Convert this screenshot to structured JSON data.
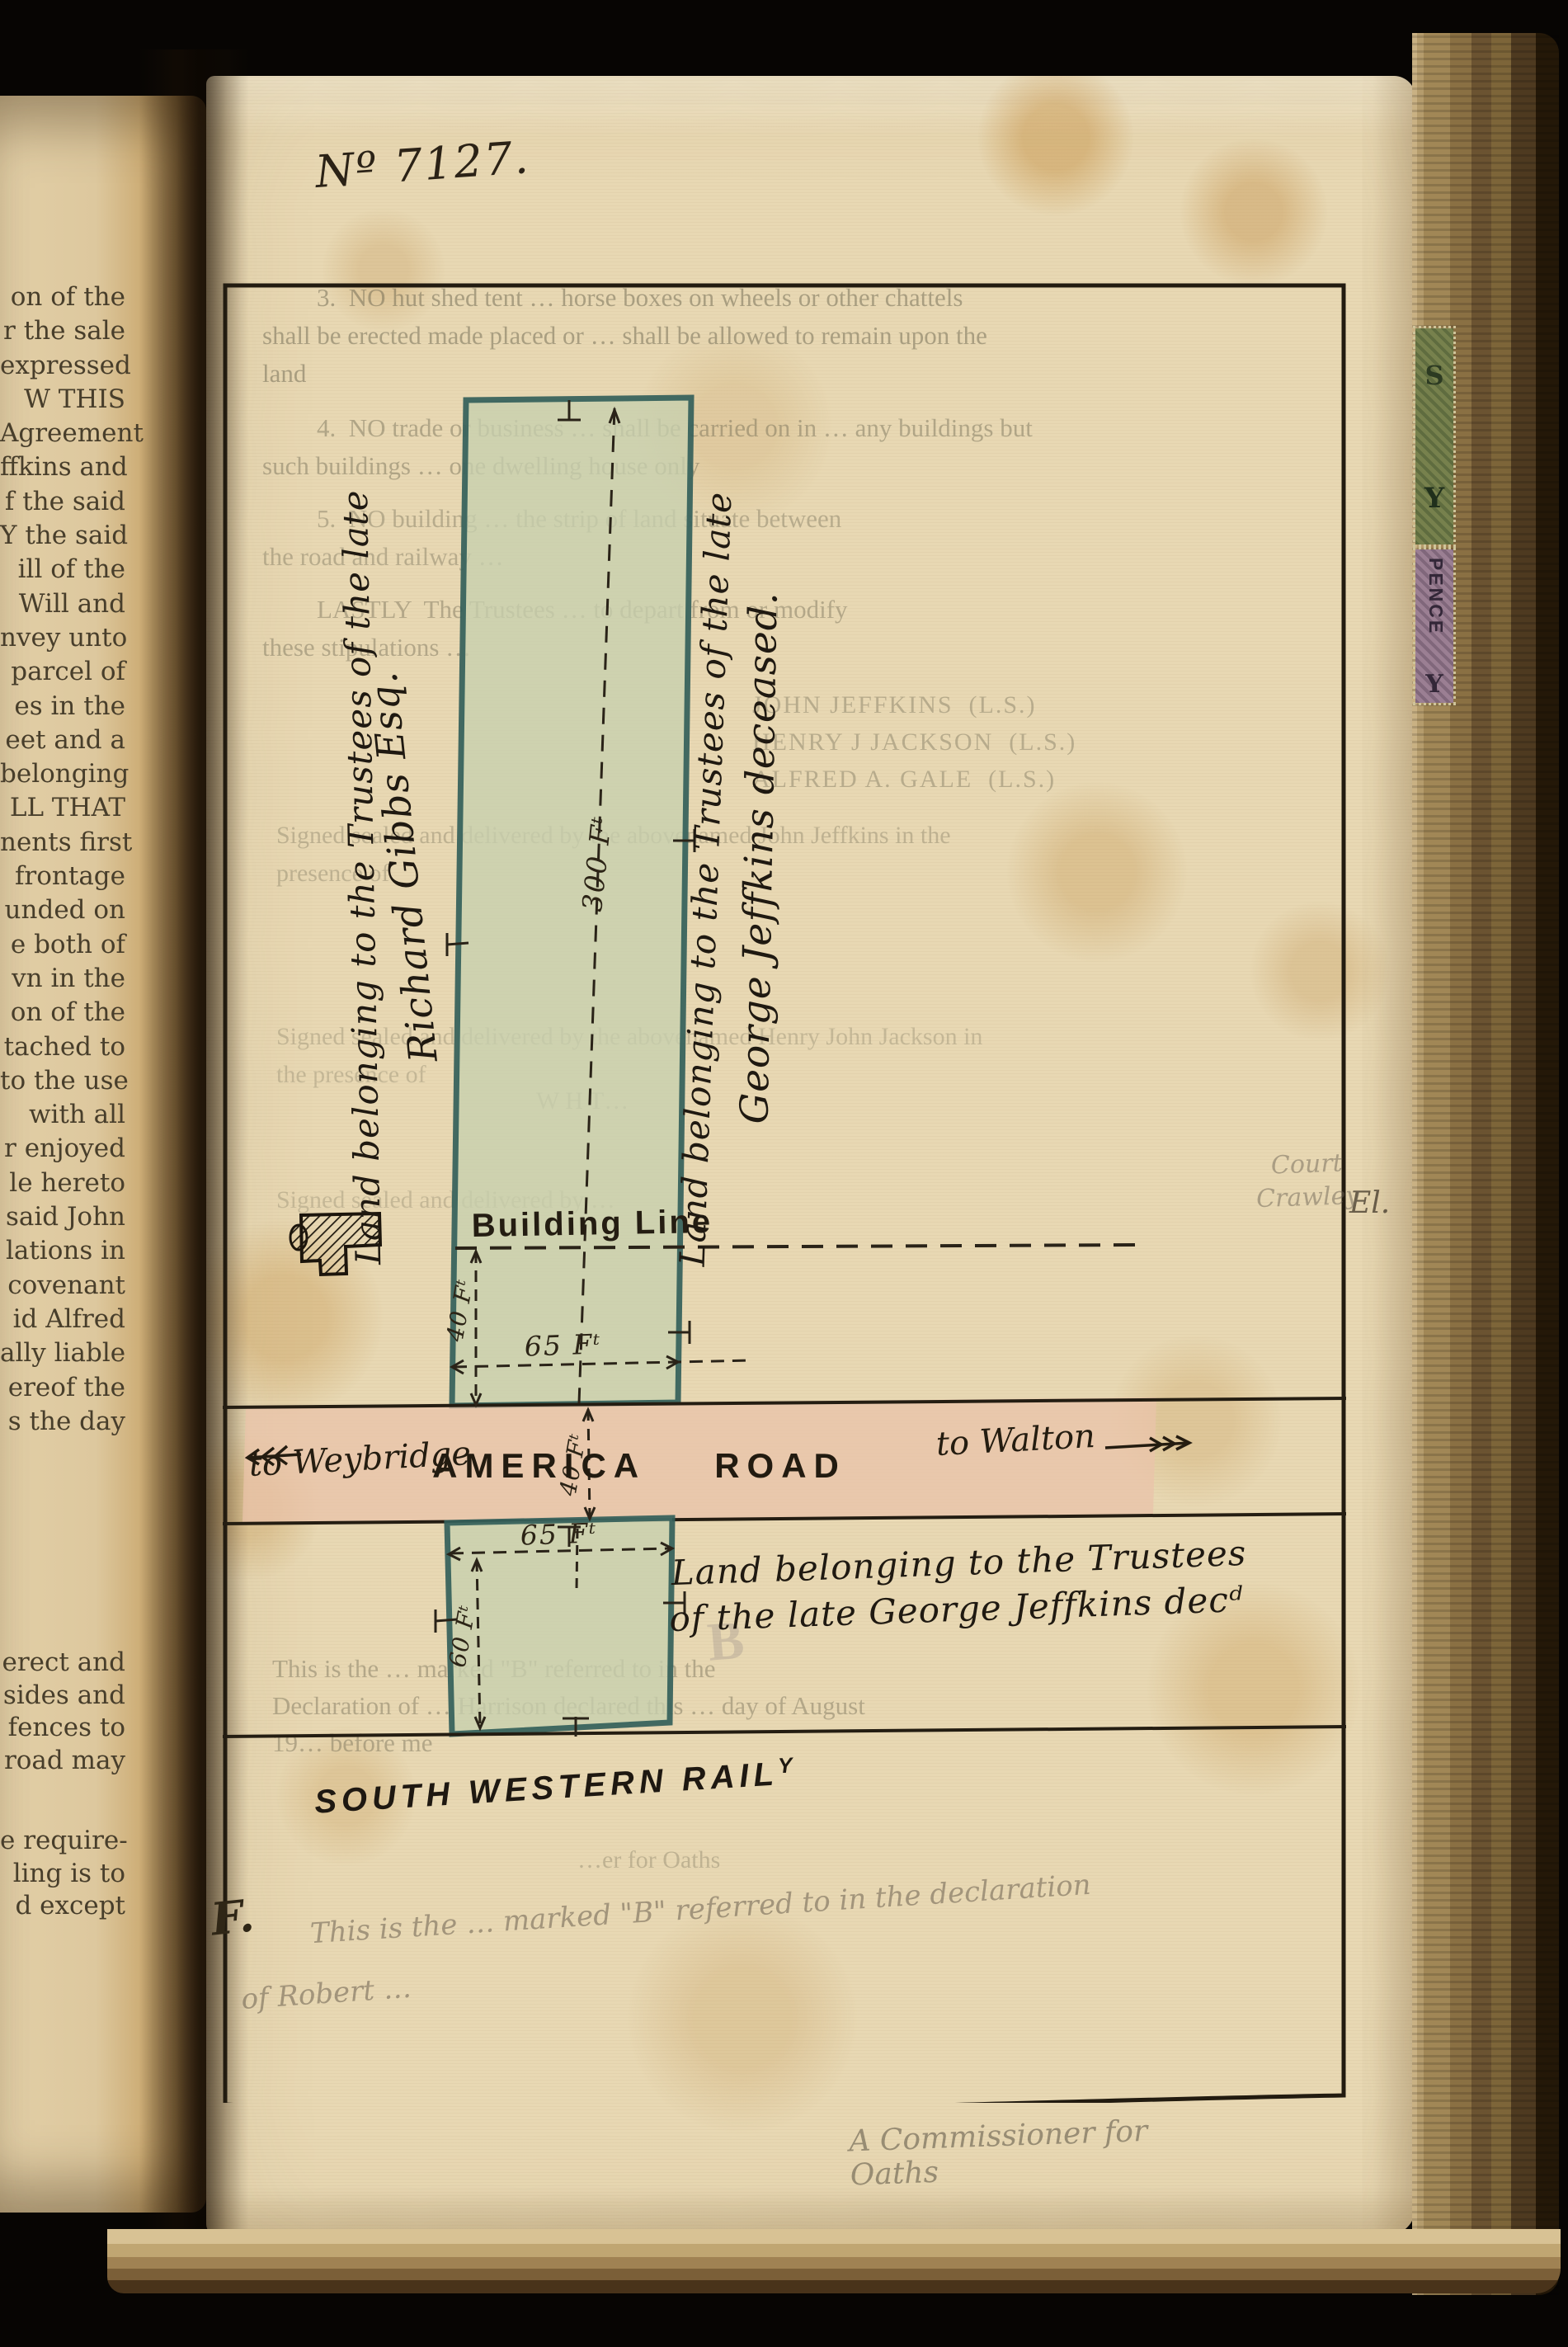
{
  "page_label": "Nº 7127.",
  "left_page": {
    "block1": [
      "on of the",
      "r the sale",
      "expressed",
      "W THIS",
      "Agreement",
      "ffkins and",
      "f the said",
      "Y the said",
      "ill of the",
      "Will and",
      "nvey unto",
      "parcel of",
      "es in the",
      "eet and a",
      "belonging",
      "LL THAT",
      "nents first",
      "frontage",
      "unded on",
      "e both of",
      "vn in the",
      "on of the",
      "tached to",
      "to the use",
      "with all",
      "r enjoyed",
      "le hereto",
      "said John",
      "lations in",
      "covenant",
      "id Alfred",
      "ally liable",
      "ereof the",
      "s the day"
    ],
    "block2": [
      "erect and",
      "sides and",
      "fences to",
      "road may"
    ],
    "block3": [
      "e require-",
      "ling is to",
      "d except"
    ]
  },
  "plan": {
    "labels": {
      "left_line1": "Land belonging to the Trustees of the late",
      "left_line2": "Richard Gibbs Esq.",
      "right_line1": "Land belonging to the Trustees of the late",
      "right_line2": "George Jeffkins deceased.",
      "lower_line1": "Land belonging to the Trustees",
      "lower_line2": "of the late George Jeffkins decᵈ",
      "building_line": "Building Line",
      "road_name": "AMERICA ROAD",
      "road_west": "to Weybridge",
      "road_east": "to Walton",
      "railway": "SOUTH WESTERN RAIL",
      "railway_sup": "Y"
    },
    "dimensions": {
      "strip_length": "300 Fᵗ",
      "setback": "40 Fᵗ",
      "frontage_north": "65 Fᵗ",
      "road_width": "40 Fᵗ",
      "frontage_south": "65 Fᵗ",
      "south_depth": "60 Fᵗ"
    },
    "colors": {
      "parcel_fill": "#c6cfae",
      "parcel_border": "#34605a",
      "road_fill": "#e9c3a9",
      "ink": "#2a2217"
    }
  },
  "ghost_text": {
    "clause3": [
      "3.  NO hut shed tent … horse boxes on wheels or other chattels",
      "shall be erected made placed or … shall be allowed to remain upon the",
      "land"
    ],
    "clause4": [
      "4.  NO trade or business … shall be carried on in … any buildings but",
      "such buildings … one dwelling house only"
    ],
    "clause5": [
      "5.  NO building … the strip of land situate between",
      "the road and railway …"
    ],
    "lastly": [
      "LASTLY  The Trustees … to depart from or modify",
      "these stipulations …"
    ],
    "signatures": [
      "JOHN JEFFKINS  (L.S.)",
      "HENRY J JACKSON  (L.S.)",
      "ALFRED A. GALE  (L.S.)"
    ],
    "attestation1": [
      "Signed sealed and delivered by the abovenamed John Jeffkins in the",
      "presence of"
    ],
    "attestation2": [
      "Signed sealed and delivered by the abovenamed Henry John Jackson in",
      "the presence of"
    ],
    "witness": [
      "W H T…"
    ],
    "attestation3": [
      "Signed sealed and delivered by …"
    ],
    "exhibit": [
      "This is the … marked \"B\" referred to in the",
      "Declaration of … Harrison declared this … day of August",
      "19… before me"
    ],
    "commissioner": "…er for Oaths",
    "stamp_letter": "B"
  },
  "handwriting": {
    "note1": "This is the … marked \"B\" referred to in the declaration",
    "note2": "of Robert …",
    "signature": "A Commissioner for Oaths",
    "margin_right": "El.",
    "pen_mark": "F.",
    "court_note": [
      "Court",
      "Crawley"
    ]
  },
  "edge_stamps": {
    "green_letters": [
      "S",
      "Y"
    ],
    "purple_text": "PENCE",
    "purple_letter": "Y"
  }
}
